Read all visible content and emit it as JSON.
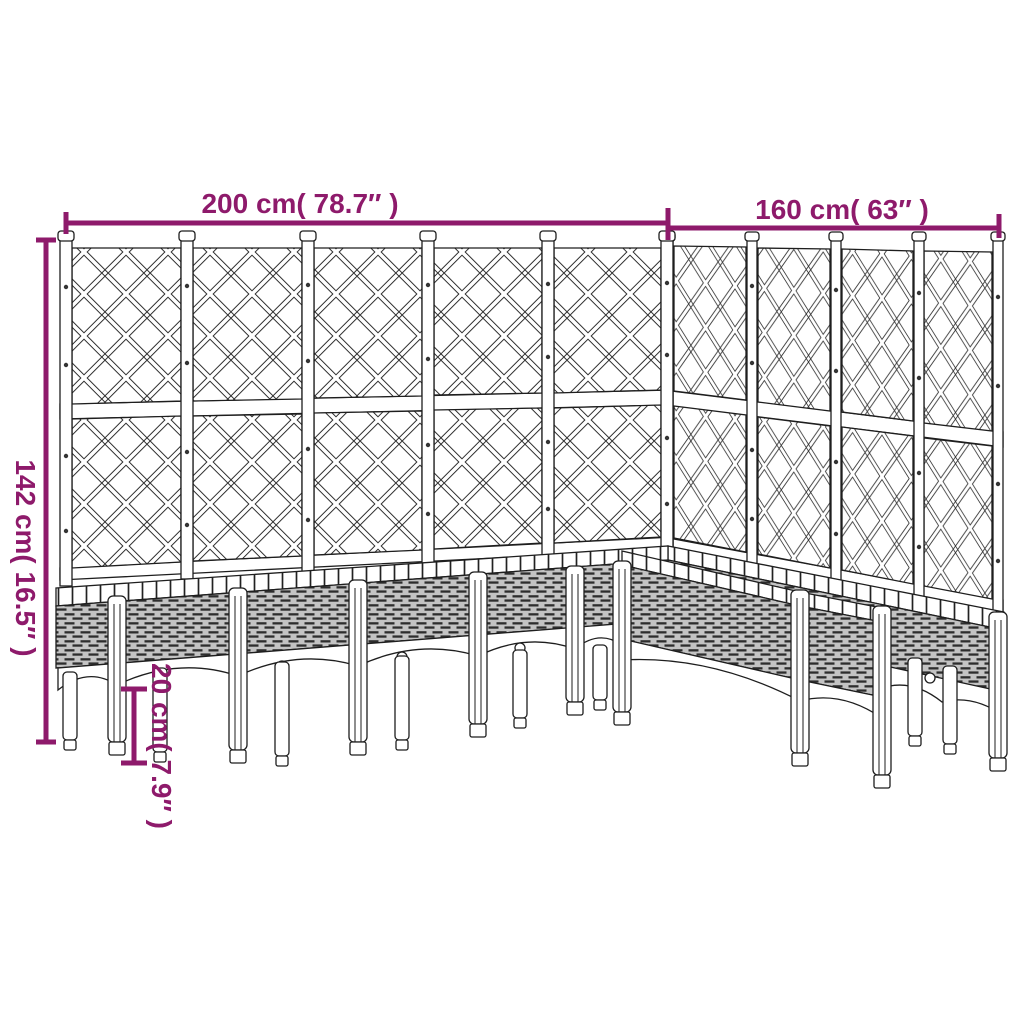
{
  "colors": {
    "dimension_accent": "#8E1A6B",
    "drawing_line": "#1e1e1e",
    "background": "#ffffff"
  },
  "dimensions": {
    "width_left_wall": {
      "label": "200 cm( 78.7″ )"
    },
    "width_right_wall": {
      "label": "160 cm( 63″ )"
    },
    "height_total": {
      "label": "142 cm( 16.5″ )"
    },
    "height_legs": {
      "label": "20 cm( 7.9″ )"
    }
  }
}
